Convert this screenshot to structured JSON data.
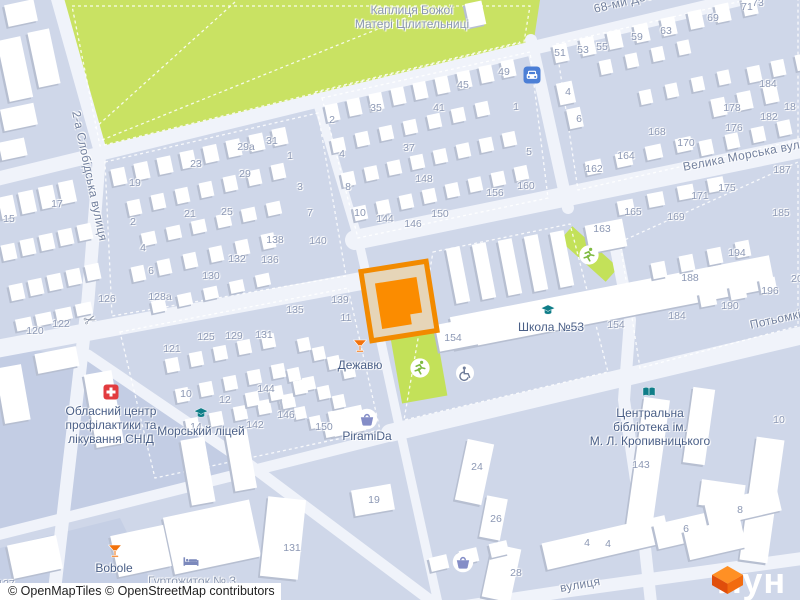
{
  "attribution": "© OpenMapTiles © OpenStreetMap contributors",
  "logo": {
    "text": "лун",
    "accent": "#F26B0F"
  },
  "streets": [
    {
      "label": "2-а Слобідська вулиця",
      "x": 76,
      "y": 104,
      "rot": 78
    },
    {
      "label": "68-ми Десантників",
      "x": 594,
      "y": 2,
      "rot": -13.5
    },
    {
      "label": "Велика Морська вулиця",
      "x": 683,
      "y": 160,
      "rot": -11
    },
    {
      "label": "Потьомкінська",
      "x": 750,
      "y": 318,
      "rot": -12.5
    },
    {
      "label": "вулиця",
      "x": 560,
      "y": 581,
      "rot": -10
    }
  ],
  "pois": [
    {
      "name": "chapel",
      "lines": [
        "Каплиця Божої",
        "Матері Цілительниці"
      ],
      "lx": 412,
      "ly": 17,
      "cls": "muted"
    },
    {
      "name": "school-53",
      "lines": [
        "Школа №53"
      ],
      "lx": 551,
      "ly": 327,
      "cls": "",
      "icon": "school",
      "ix": 548,
      "iy": 310
    },
    {
      "name": "naval-lyceum",
      "lines": [
        "Морський ліцей"
      ],
      "lx": 201,
      "ly": 431,
      "cls": "",
      "icon": "school",
      "ix": 201,
      "iy": 413
    },
    {
      "name": "central-library",
      "lines": [
        "Центральна",
        "бібліотека ім.",
        "М. Л. Кропивницького"
      ],
      "lx": 650,
      "ly": 427,
      "cls": "",
      "icon": "book",
      "ix": 649,
      "iy": 392
    },
    {
      "name": "aids-center",
      "lines": [
        "Обласний центр",
        "профілактики та",
        "лікування СНІД"
      ],
      "lx": 111,
      "ly": 425,
      "cls": "",
      "icon": "hospital",
      "ix": 111,
      "iy": 392
    },
    {
      "name": "dejavu-bar",
      "lines": [
        "Дежавю"
      ],
      "lx": 360,
      "ly": 365,
      "cls": "",
      "icon": "cocktail",
      "ix": 360,
      "iy": 346
    },
    {
      "name": "piramida-shop",
      "lines": [
        "PiramiDa"
      ],
      "lx": 367,
      "ly": 436,
      "cls": "",
      "icon": "basket",
      "ix": 367,
      "iy": 419
    },
    {
      "name": "bobole-bar",
      "lines": [
        "Bobole"
      ],
      "lx": 114,
      "ly": 568,
      "cls": "",
      "icon": "cocktail",
      "ix": 115,
      "iy": 551
    },
    {
      "name": "dormitory-3",
      "lines": [
        "Гуртожиток № 3"
      ],
      "lx": 192,
      "ly": 581,
      "cls": "muted",
      "icon": "bed",
      "ix": 191,
      "iy": 562
    }
  ],
  "standalone_icons": [
    {
      "icon": "car",
      "x": 532,
      "y": 75
    },
    {
      "icon": "scissors",
      "x": 90,
      "y": 320
    },
    {
      "icon": "wheelchair",
      "x": 465,
      "y": 373
    },
    {
      "icon": "running",
      "x": 420,
      "y": 368
    },
    {
      "icon": "running",
      "x": 589,
      "y": 255
    },
    {
      "icon": "basket",
      "x": 463,
      "y": 562
    }
  ],
  "house_numbers": [
    [
      "15",
      9,
      219
    ],
    [
      "17",
      57,
      204
    ],
    [
      "120",
      35,
      331
    ],
    [
      "122",
      61,
      324
    ],
    [
      "126",
      107,
      299
    ],
    [
      "127",
      6,
      584
    ],
    [
      "19",
      135,
      183
    ],
    [
      "23",
      196,
      164
    ],
    [
      "29а",
      246,
      147
    ],
    [
      "31",
      272,
      141
    ],
    [
      "29",
      245,
      174
    ],
    [
      "1",
      290,
      156
    ],
    [
      "3",
      300,
      187
    ],
    [
      "7",
      310,
      213
    ],
    [
      "2",
      133,
      222
    ],
    [
      "4",
      143,
      248
    ],
    [
      "6",
      151,
      271
    ],
    [
      "21",
      190,
      214
    ],
    [
      "25",
      227,
      212
    ],
    [
      "128а",
      160,
      297
    ],
    [
      "130",
      211,
      276
    ],
    [
      "132",
      237,
      259
    ],
    [
      "136",
      270,
      260
    ],
    [
      "138",
      275,
      240
    ],
    [
      "140",
      318,
      241
    ],
    [
      "135",
      295,
      310
    ],
    [
      "139",
      340,
      300
    ],
    [
      "11",
      346,
      318
    ],
    [
      "125",
      206,
      337
    ],
    [
      "129",
      234,
      336
    ],
    [
      "131",
      264,
      335
    ],
    [
      "121",
      172,
      349
    ],
    [
      "10",
      186,
      394
    ],
    [
      "12",
      225,
      400
    ],
    [
      "14",
      196,
      427
    ],
    [
      "142",
      255,
      425
    ],
    [
      "144",
      266,
      389
    ],
    [
      "146",
      286,
      415
    ],
    [
      "150",
      324,
      427
    ],
    [
      "2",
      332,
      120
    ],
    [
      "35",
      376,
      108
    ],
    [
      "4",
      342,
      154
    ],
    [
      "8",
      348,
      187
    ],
    [
      "10",
      360,
      213
    ],
    [
      "37",
      409,
      148
    ],
    [
      "41",
      439,
      108
    ],
    [
      "45",
      463,
      85
    ],
    [
      "49",
      504,
      72
    ],
    [
      "1",
      516,
      107
    ],
    [
      "5",
      529,
      152
    ],
    [
      "148",
      424,
      179
    ],
    [
      "144",
      385,
      219
    ],
    [
      "146",
      413,
      224
    ],
    [
      "150",
      440,
      214
    ],
    [
      "156",
      495,
      193
    ],
    [
      "160",
      526,
      186
    ],
    [
      "51",
      560,
      53
    ],
    [
      "53",
      583,
      50
    ],
    [
      "55",
      602,
      47
    ],
    [
      "59",
      637,
      37
    ],
    [
      "63",
      666,
      31
    ],
    [
      "69",
      713,
      18
    ],
    [
      "71",
      747,
      7
    ],
    [
      "73",
      758,
      3
    ],
    [
      "4",
      568,
      92
    ],
    [
      "6",
      579,
      119
    ],
    [
      "162",
      594,
      169
    ],
    [
      "164",
      626,
      156
    ],
    [
      "168",
      657,
      132
    ],
    [
      "170",
      686,
      143
    ],
    [
      "184",
      768,
      84
    ],
    [
      "178",
      732,
      108
    ],
    [
      "182",
      769,
      117
    ],
    [
      "176",
      734,
      128
    ],
    [
      "18",
      790,
      107
    ],
    [
      "187",
      782,
      170
    ],
    [
      "175",
      727,
      188
    ],
    [
      "171",
      700,
      196
    ],
    [
      "169",
      676,
      217
    ],
    [
      "165",
      633,
      212
    ],
    [
      "163",
      602,
      229
    ],
    [
      "185",
      781,
      213
    ],
    [
      "194",
      737,
      253
    ],
    [
      "188",
      690,
      278
    ],
    [
      "196",
      770,
      291
    ],
    [
      "190",
      730,
      306
    ],
    [
      "184",
      677,
      316
    ],
    [
      "20",
      797,
      279
    ],
    [
      "154",
      453,
      338
    ],
    [
      "154",
      616,
      325
    ],
    [
      "24",
      477,
      467
    ],
    [
      "26",
      496,
      519
    ],
    [
      "28",
      516,
      573
    ],
    [
      "4",
      587,
      543
    ],
    [
      "4",
      608,
      544
    ],
    [
      "6",
      686,
      529
    ],
    [
      "8",
      740,
      510
    ],
    [
      "143",
      641,
      465
    ],
    [
      "10",
      779,
      420
    ],
    [
      "19",
      374,
      500
    ],
    [
      "131",
      292,
      548
    ]
  ]
}
